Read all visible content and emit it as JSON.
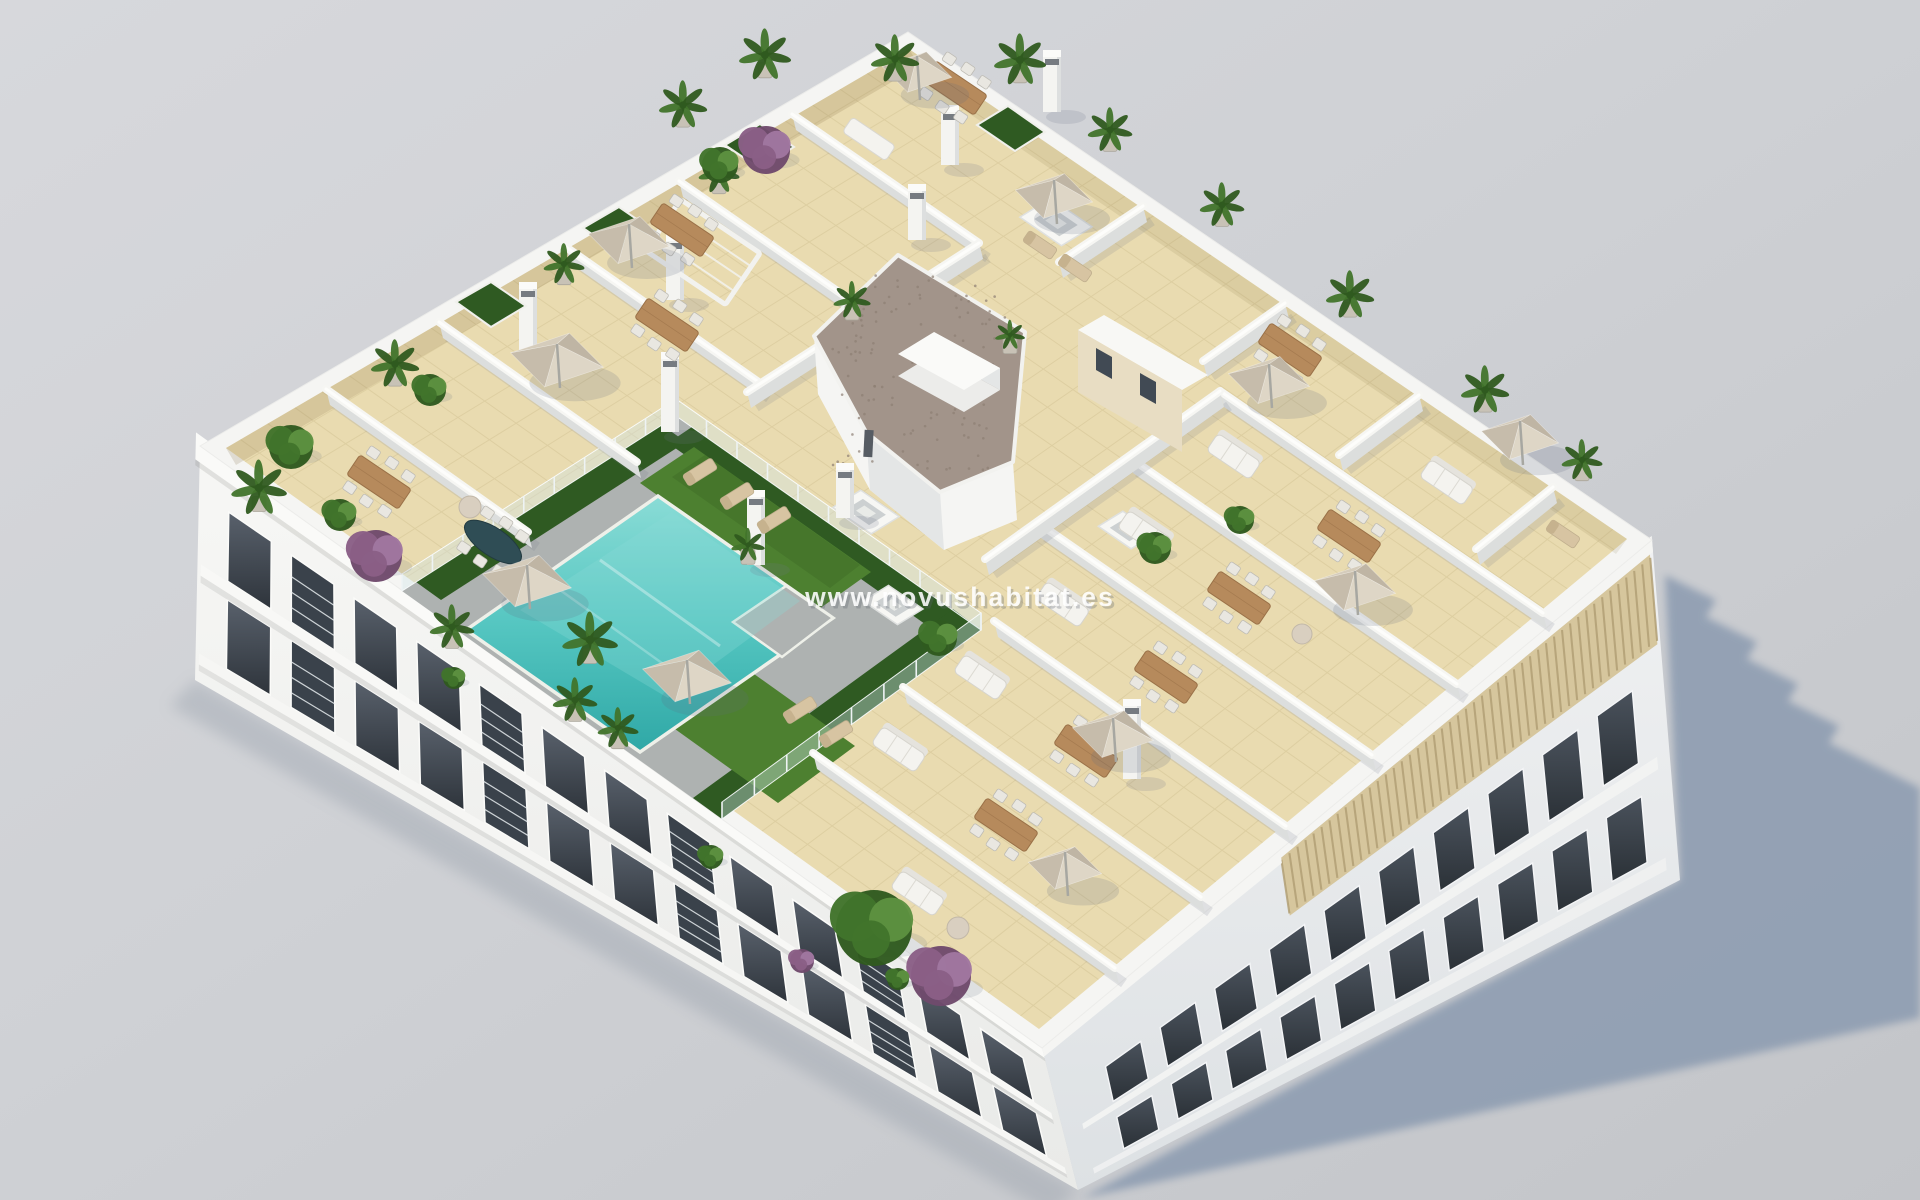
{
  "scene": {
    "type": "3d-architectural-render",
    "subject": "aerial-view-apartment-building-rooftop-with-communal-pool-and-terraces",
    "watermark": "www.novushabitat.es"
  },
  "palette": {
    "bg_top": "#d7d8dc",
    "bg_mid": "#cfd1d5",
    "bg_bottom": "#c3c5c9",
    "shadow": "#8d9cb1",
    "wall_white": "#f5f5f3",
    "wall_shade": "#e4e6e6",
    "parapet_shade": "#dcdedd",
    "floor_tile": "#e9dbb0",
    "tile_line": "#a8925c",
    "deck_gray": "#aeb2b1",
    "pool": "#55c6c1",
    "pool_light": "#8adcd6",
    "pool_deep": "#2fa8a6",
    "grass": "#4d8030",
    "grass_dark": "#3a6522",
    "hedge": "#2f5a22",
    "gravel": "#a2948a",
    "gravel_dot": "#8d7f74",
    "louver": "#d6c69d",
    "louver_dark": "#b2a076",
    "wood": "#b68a5c",
    "wood_dark": "#9a7148",
    "chair": "#e9e7e1",
    "sofa": "#f4f3ef",
    "parasol_light": "#ded6c6",
    "parasol_dark": "#c6bcab",
    "window_glass": "#414a54",
    "window_glass_dark": "#2e343b",
    "plant_dark": "#2f5a1f",
    "plant_mid": "#41742b",
    "plant_light": "#5d9140",
    "plant_purple": "#8a5f86",
    "pot": "#c8c2b6",
    "glass_fence": "#d0e5e9",
    "watermark_color": "#ffffff"
  }
}
